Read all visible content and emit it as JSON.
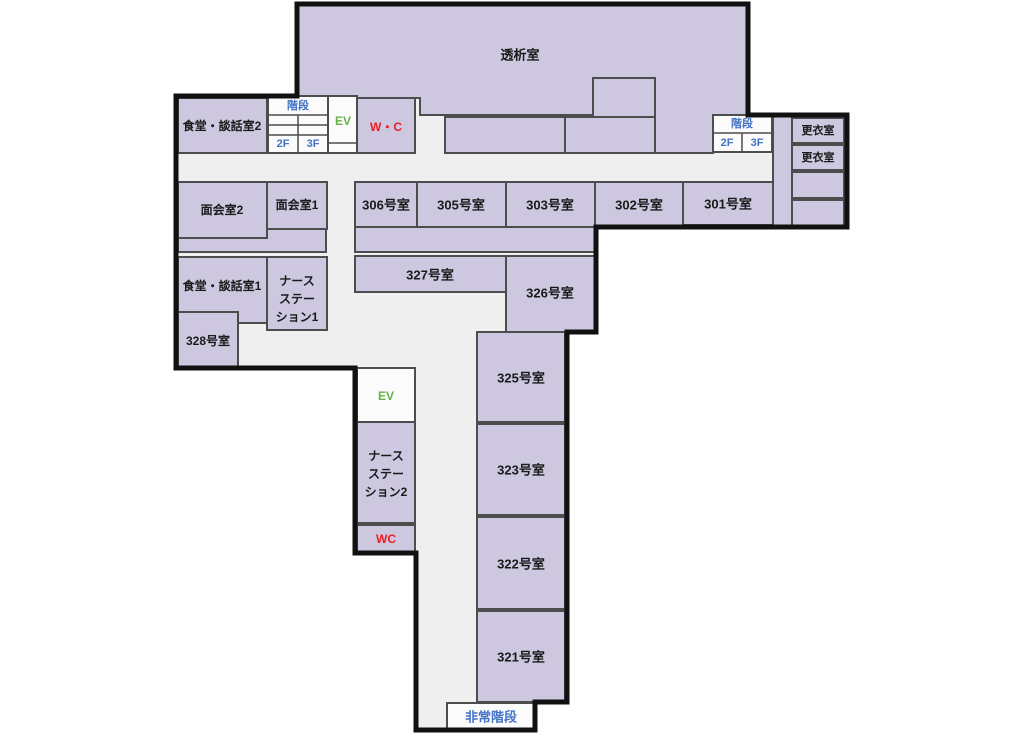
{
  "floor_plan": {
    "rooms": {
      "dialysis": "透析室",
      "dining_lounge_2": "食堂・談話室2",
      "dining_lounge_1": "食堂・談話室1",
      "meeting_2": "面会室2",
      "meeting_1": "面会室1",
      "nurse_station_1": [
        "ナース",
        "ステー",
        "ション1"
      ],
      "nurse_station_2": [
        "ナース",
        "ステー",
        "ション2"
      ],
      "room_328": "328号室",
      "room_327": "327号室",
      "room_326": "326号室",
      "room_325": "325号室",
      "room_323": "323号室",
      "room_322": "322号室",
      "room_321": "321号室",
      "room_306": "306号室",
      "room_305": "305号室",
      "room_303": "303号室",
      "room_302": "302号室",
      "room_301": "301号室",
      "locker_room": "更衣室",
      "wc_main": "W・C",
      "wc_small": "WC",
      "elevator": "EV",
      "stairs": "階段",
      "emergency_stairs": "非常階段",
      "floor_2f": "2F",
      "floor_3f": "3F"
    },
    "colors": {
      "room_fill": "#cdc7e0",
      "corridor_fill": "#efefef",
      "light_fill": "#fbfbfb",
      "wall": "#111111",
      "room_border": "#4d4d4d",
      "text": "#1a1a1a",
      "blue": "#4472c4",
      "green": "#65b245",
      "red": "#ed1c24"
    }
  }
}
